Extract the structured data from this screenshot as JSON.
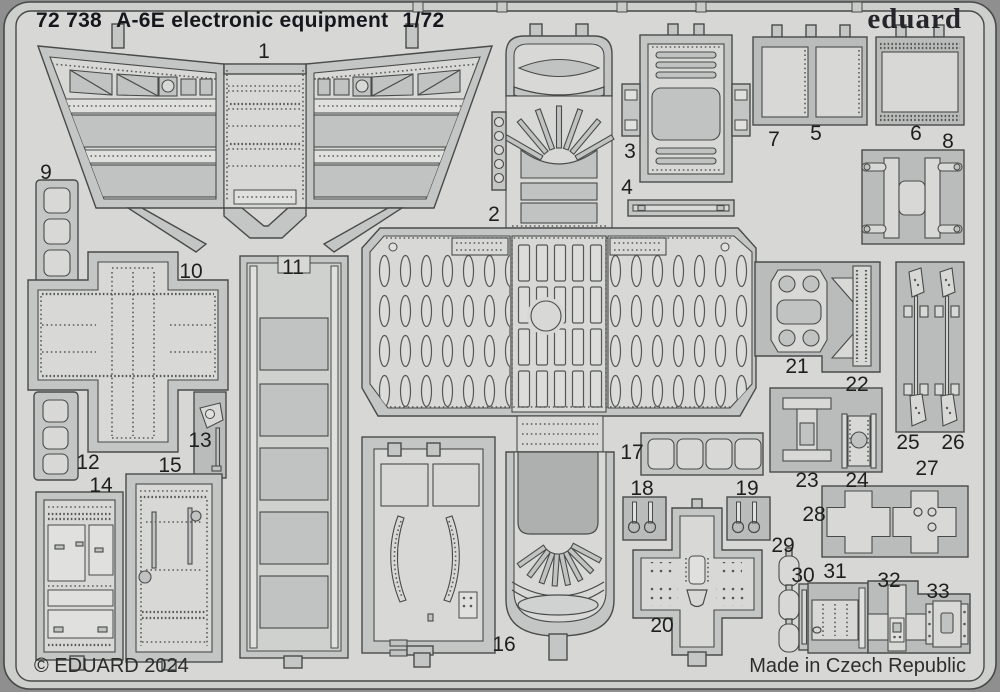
{
  "header": {
    "catalog_number": "72 738",
    "title": "A-6E electronic equipment",
    "scale": "1/72",
    "brand": "eduard"
  },
  "footer": {
    "copyright": "© EDUARD 2024",
    "made_in": "Made in Czech Republic"
  },
  "sheet": {
    "description": "photo-etched parts fret",
    "part_count": 33
  },
  "colors": {
    "background": "#8e8f8e",
    "sheet_field": "#d7d8d6",
    "rail_band": "#cdcfcc",
    "metal_frame": "#c3c6c4",
    "plate_backing": "#b9bcba",
    "part_light": "#d8d9d7",
    "part_dark": "#adb0ae",
    "outline": "#494b4a",
    "text": "#16161d"
  },
  "parts": [
    {
      "num": "1"
    },
    {
      "num": "2"
    },
    {
      "num": "3"
    },
    {
      "num": "4"
    },
    {
      "num": "5"
    },
    {
      "num": "6"
    },
    {
      "num": "7"
    },
    {
      "num": "8"
    },
    {
      "num": "9"
    },
    {
      "num": "10"
    },
    {
      "num": "11"
    },
    {
      "num": "12"
    },
    {
      "num": "13"
    },
    {
      "num": "14"
    },
    {
      "num": "15"
    },
    {
      "num": "16"
    },
    {
      "num": "17"
    },
    {
      "num": "18"
    },
    {
      "num": "19"
    },
    {
      "num": "20"
    },
    {
      "num": "21"
    },
    {
      "num": "22"
    },
    {
      "num": "23"
    },
    {
      "num": "24"
    },
    {
      "num": "25"
    },
    {
      "num": "26"
    },
    {
      "num": "27"
    },
    {
      "num": "28"
    },
    {
      "num": "29"
    },
    {
      "num": "30"
    },
    {
      "num": "31"
    },
    {
      "num": "32"
    },
    {
      "num": "33"
    }
  ]
}
